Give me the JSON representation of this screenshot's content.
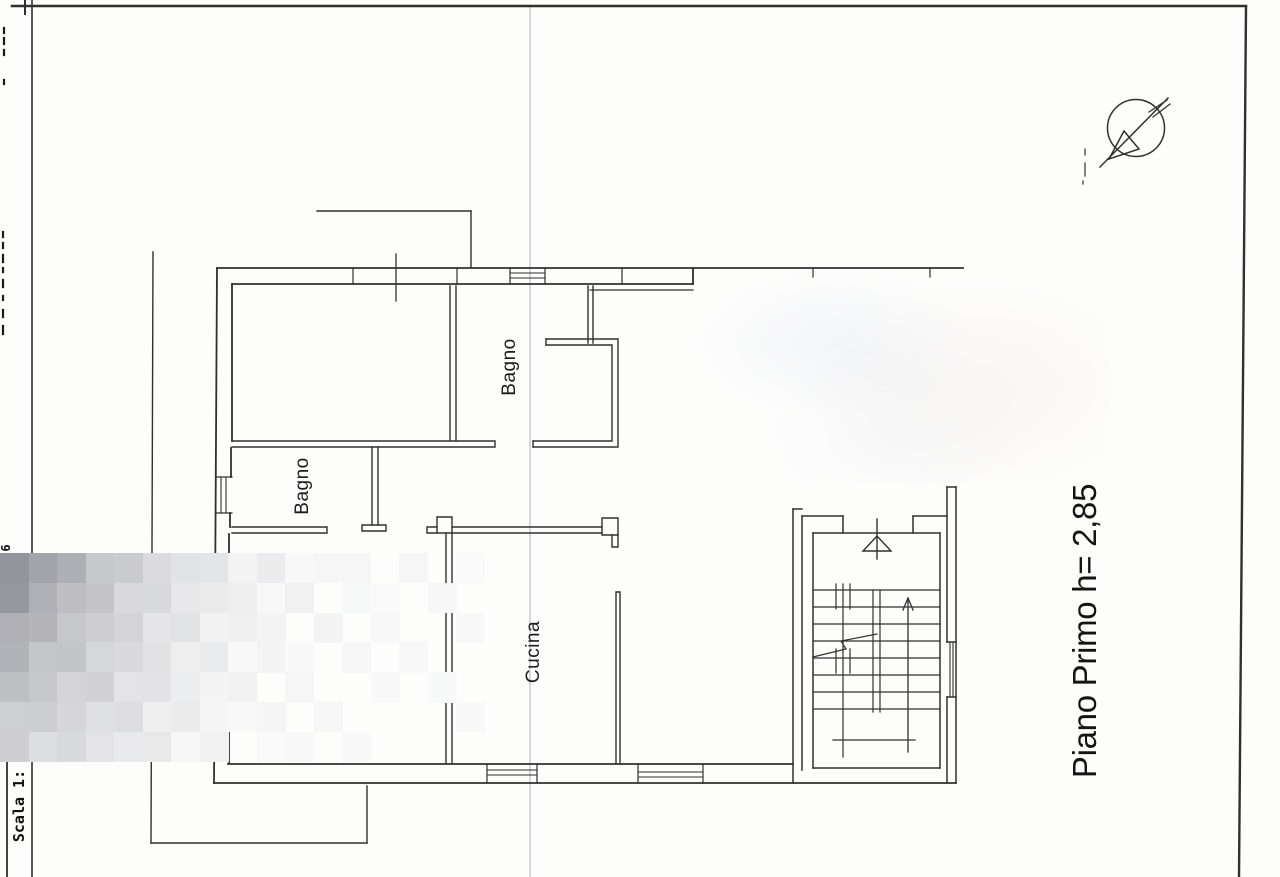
{
  "sheet": {
    "floor_title": "Piano Primo h= 2,85",
    "scale_label": "Scala 1:",
    "margin_number": "6",
    "rooms": [
      {
        "label": "Bagno"
      },
      {
        "label": "Bagno"
      },
      {
        "label": "Cucina"
      }
    ],
    "icons": {
      "north_arrow": "compass-north-arrow-icon"
    },
    "colors": {
      "ink": "#303030",
      "paper": "#fdfdfc",
      "fold_line": "#d6d6d8",
      "blur_dark": "#94959c"
    }
  }
}
